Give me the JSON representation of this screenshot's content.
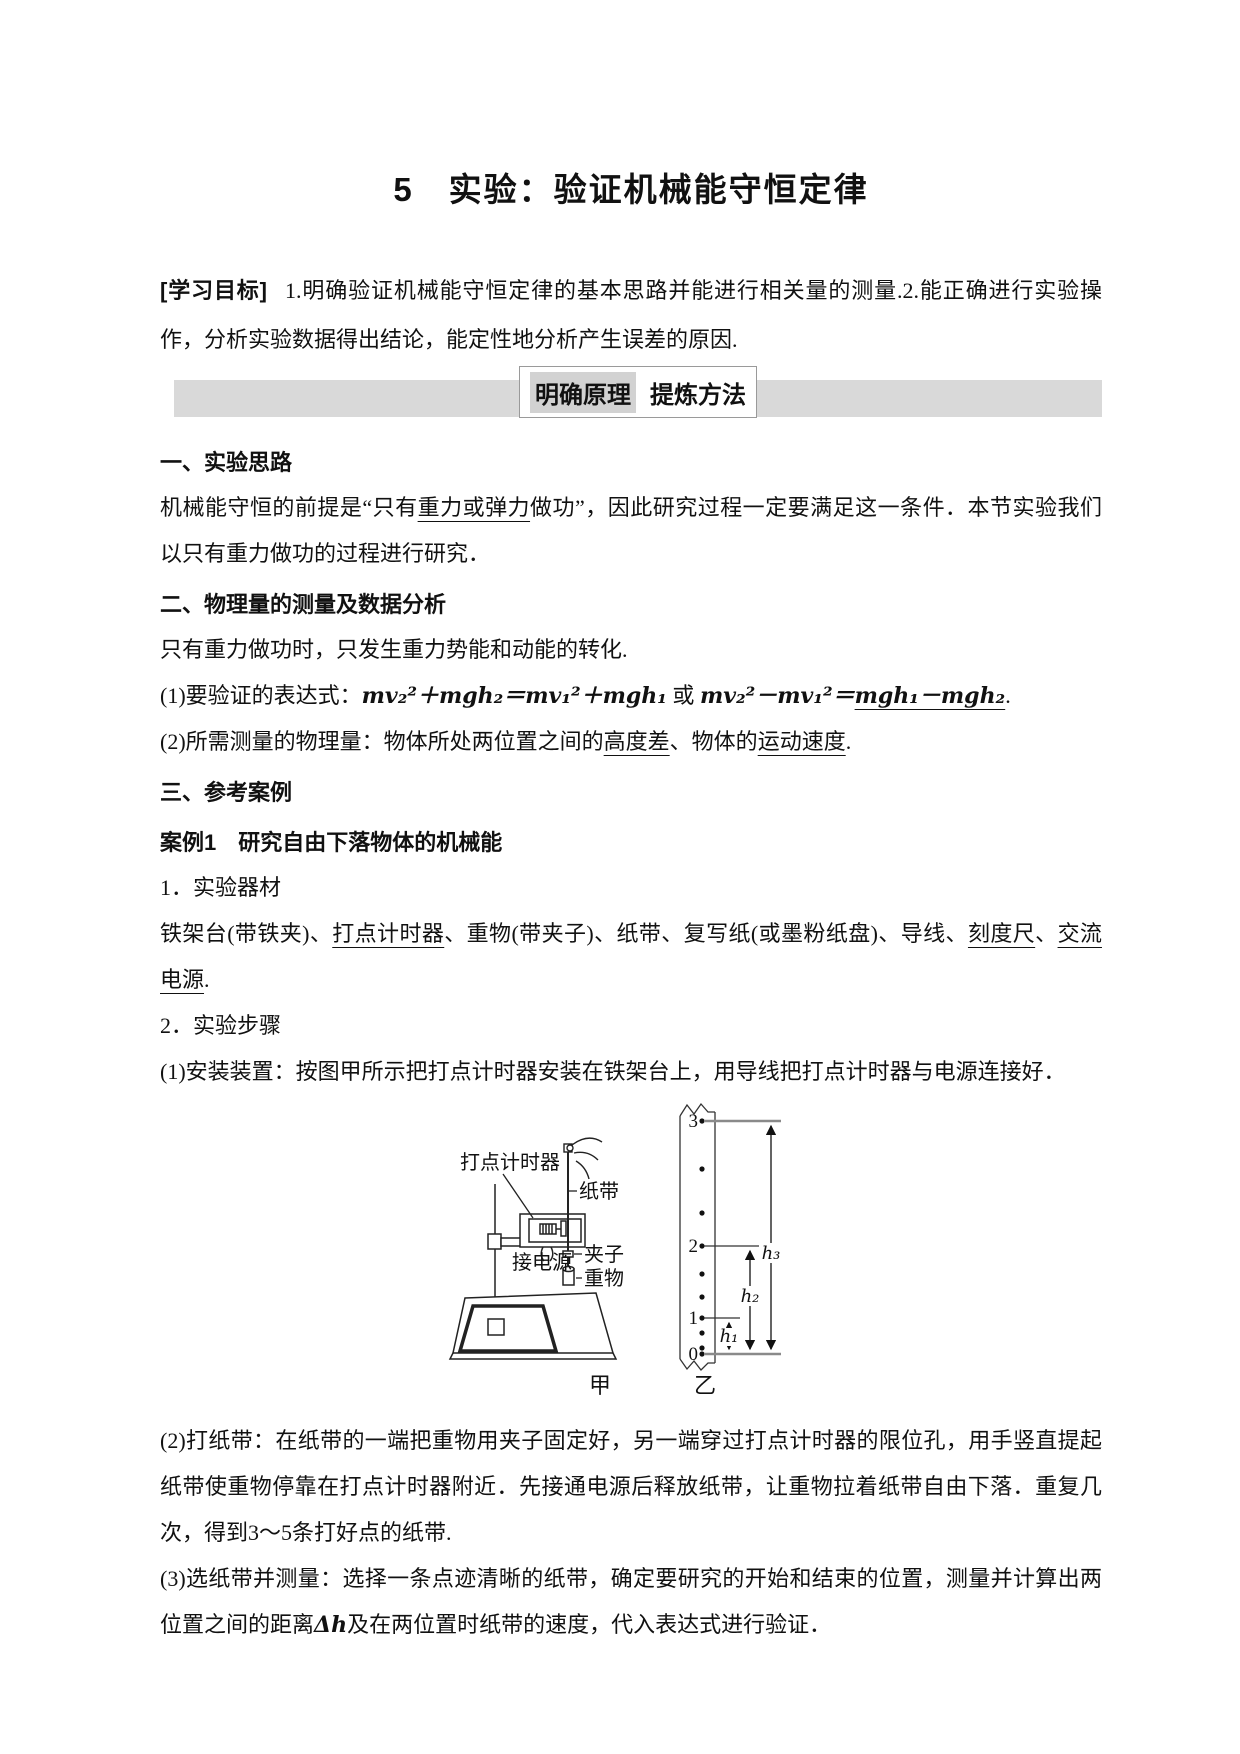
{
  "page": {
    "title": "5　实验：验证机械能守恒定律"
  },
  "objectives": {
    "label": "[学习目标]",
    "text": "1.明确验证机械能守恒定律的基本思路并能进行相关量的测量.2.能正确进行实验操作，分析实验数据得出结论，能定性地分析产生误差的原因."
  },
  "banner": {
    "tab_left": "明确原理",
    "tab_right": "提炼方法"
  },
  "colors": {
    "banner_bar": "#d9d9d9",
    "tab_highlight": "#d2d2d2",
    "measure_line_gray": "#8a8a8a"
  },
  "section1": {
    "heading": "一、实验思路",
    "p1": [
      "机械能守恒的前提是“只有",
      "重力或弹力",
      "做功”，因此研究过程一定要满足这一条件．本节实验我们以只有重力做功的过程进行研究．"
    ]
  },
  "section2": {
    "heading": "二、物理量的测量及数据分析",
    "p1": "只有重力做功时，只发生重力势能和动能的转化.",
    "formula": {
      "prefix": "(1)要验证的表达式：",
      "eq1": "mv₂²＋mgh₂＝mv₁²＋mgh₁",
      "or": " 或 ",
      "eq2": "mv₂²－mv₁²＝",
      "eq3": "mgh₁－mgh₂",
      "period": "."
    },
    "p2": [
      "(2)所需测量的物理量：物体所处两位置之间的",
      "高度差",
      "、物体的",
      "运动速度",
      "."
    ]
  },
  "section3": {
    "heading": "三、参考案例",
    "case_heading": "案例1　研究自由下落物体的机械能",
    "sub1": "1．实验器材",
    "equipment": [
      "铁架台(带铁夹)、",
      "打点计时器",
      "、重物(带夹子)、纸带、复写纸(或墨粉纸盘)、导线、",
      "刻度尺",
      "、",
      "交流电源",
      "."
    ],
    "sub2": "2．实验步骤",
    "step1": "(1)安装装置：按图甲所示把打点计时器安装在铁架台上，用导线把打点计时器与电源连接好．",
    "step2": "(2)打纸带：在纸带的一端把重物用夹子固定好，另一端穿过打点计时器的限位孔，用手竖直提起纸带使重物停靠在打点计时器附近．先接通电源后释放纸带，让重物拉着纸带自由下落．重复几次，得到3～5条打好点的纸带.",
    "step3": [
      "(3)选纸带并测量：选择一条点迹清晰的纸带，确定要研究的开始和结束的位置，测量并计算出两位置之间的距离",
      "Δh",
      "及在两位置时纸带的速度，代入表达式进行验证．"
    ]
  },
  "figure": {
    "labels": {
      "timer": "打点计时器",
      "tape": "纸带",
      "power": "接电源",
      "clip": "夹子",
      "weight": "重物",
      "caption_jia": "甲",
      "caption_yi": "乙",
      "p3": "3",
      "p2": "2",
      "p1": "1",
      "p0": "0",
      "h1": "h₁",
      "h2": "h₂",
      "h3": "h₃"
    }
  }
}
